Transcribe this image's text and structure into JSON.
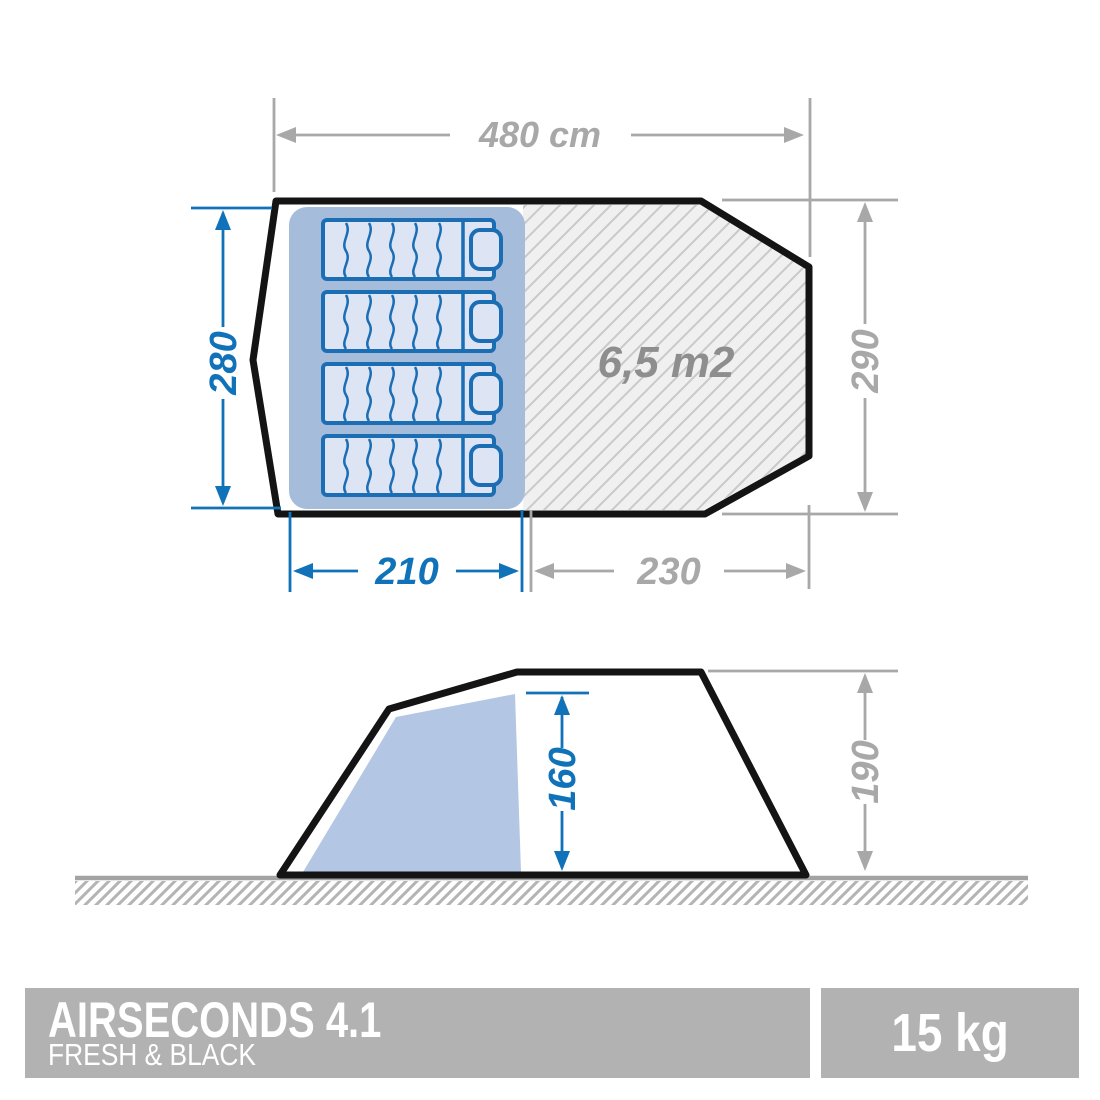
{
  "top_view": {
    "total_width_label": "480 cm",
    "left_depth_label": "280",
    "right_depth_label": "290",
    "bedroom_width_label": "210",
    "living_width_label": "230",
    "living_area_label": "6,5 m2"
  },
  "side_view": {
    "inner_height_label": "160",
    "outer_height_label": "190"
  },
  "footer": {
    "product_name": "AIRSECONDS 4.1",
    "product_line": "FRESH & BLACK",
    "weight": "15 kg"
  },
  "colors": {
    "accent_blue": "#1072b8",
    "dimension_gray": "#a8a8a8",
    "area_text_gray": "#8e8e8e",
    "panel_gray": "#b2b2b2",
    "bedroom_fill": "#a6bcdb",
    "mattress_fill": "#dde4f4",
    "mattress_stroke": "#1b6db4",
    "hatch_bg": "#f0f0f0",
    "hatch_line": "#c9c9c9",
    "side_bedroom_fill": "#b3c6e3",
    "outline_black": "#141414"
  }
}
